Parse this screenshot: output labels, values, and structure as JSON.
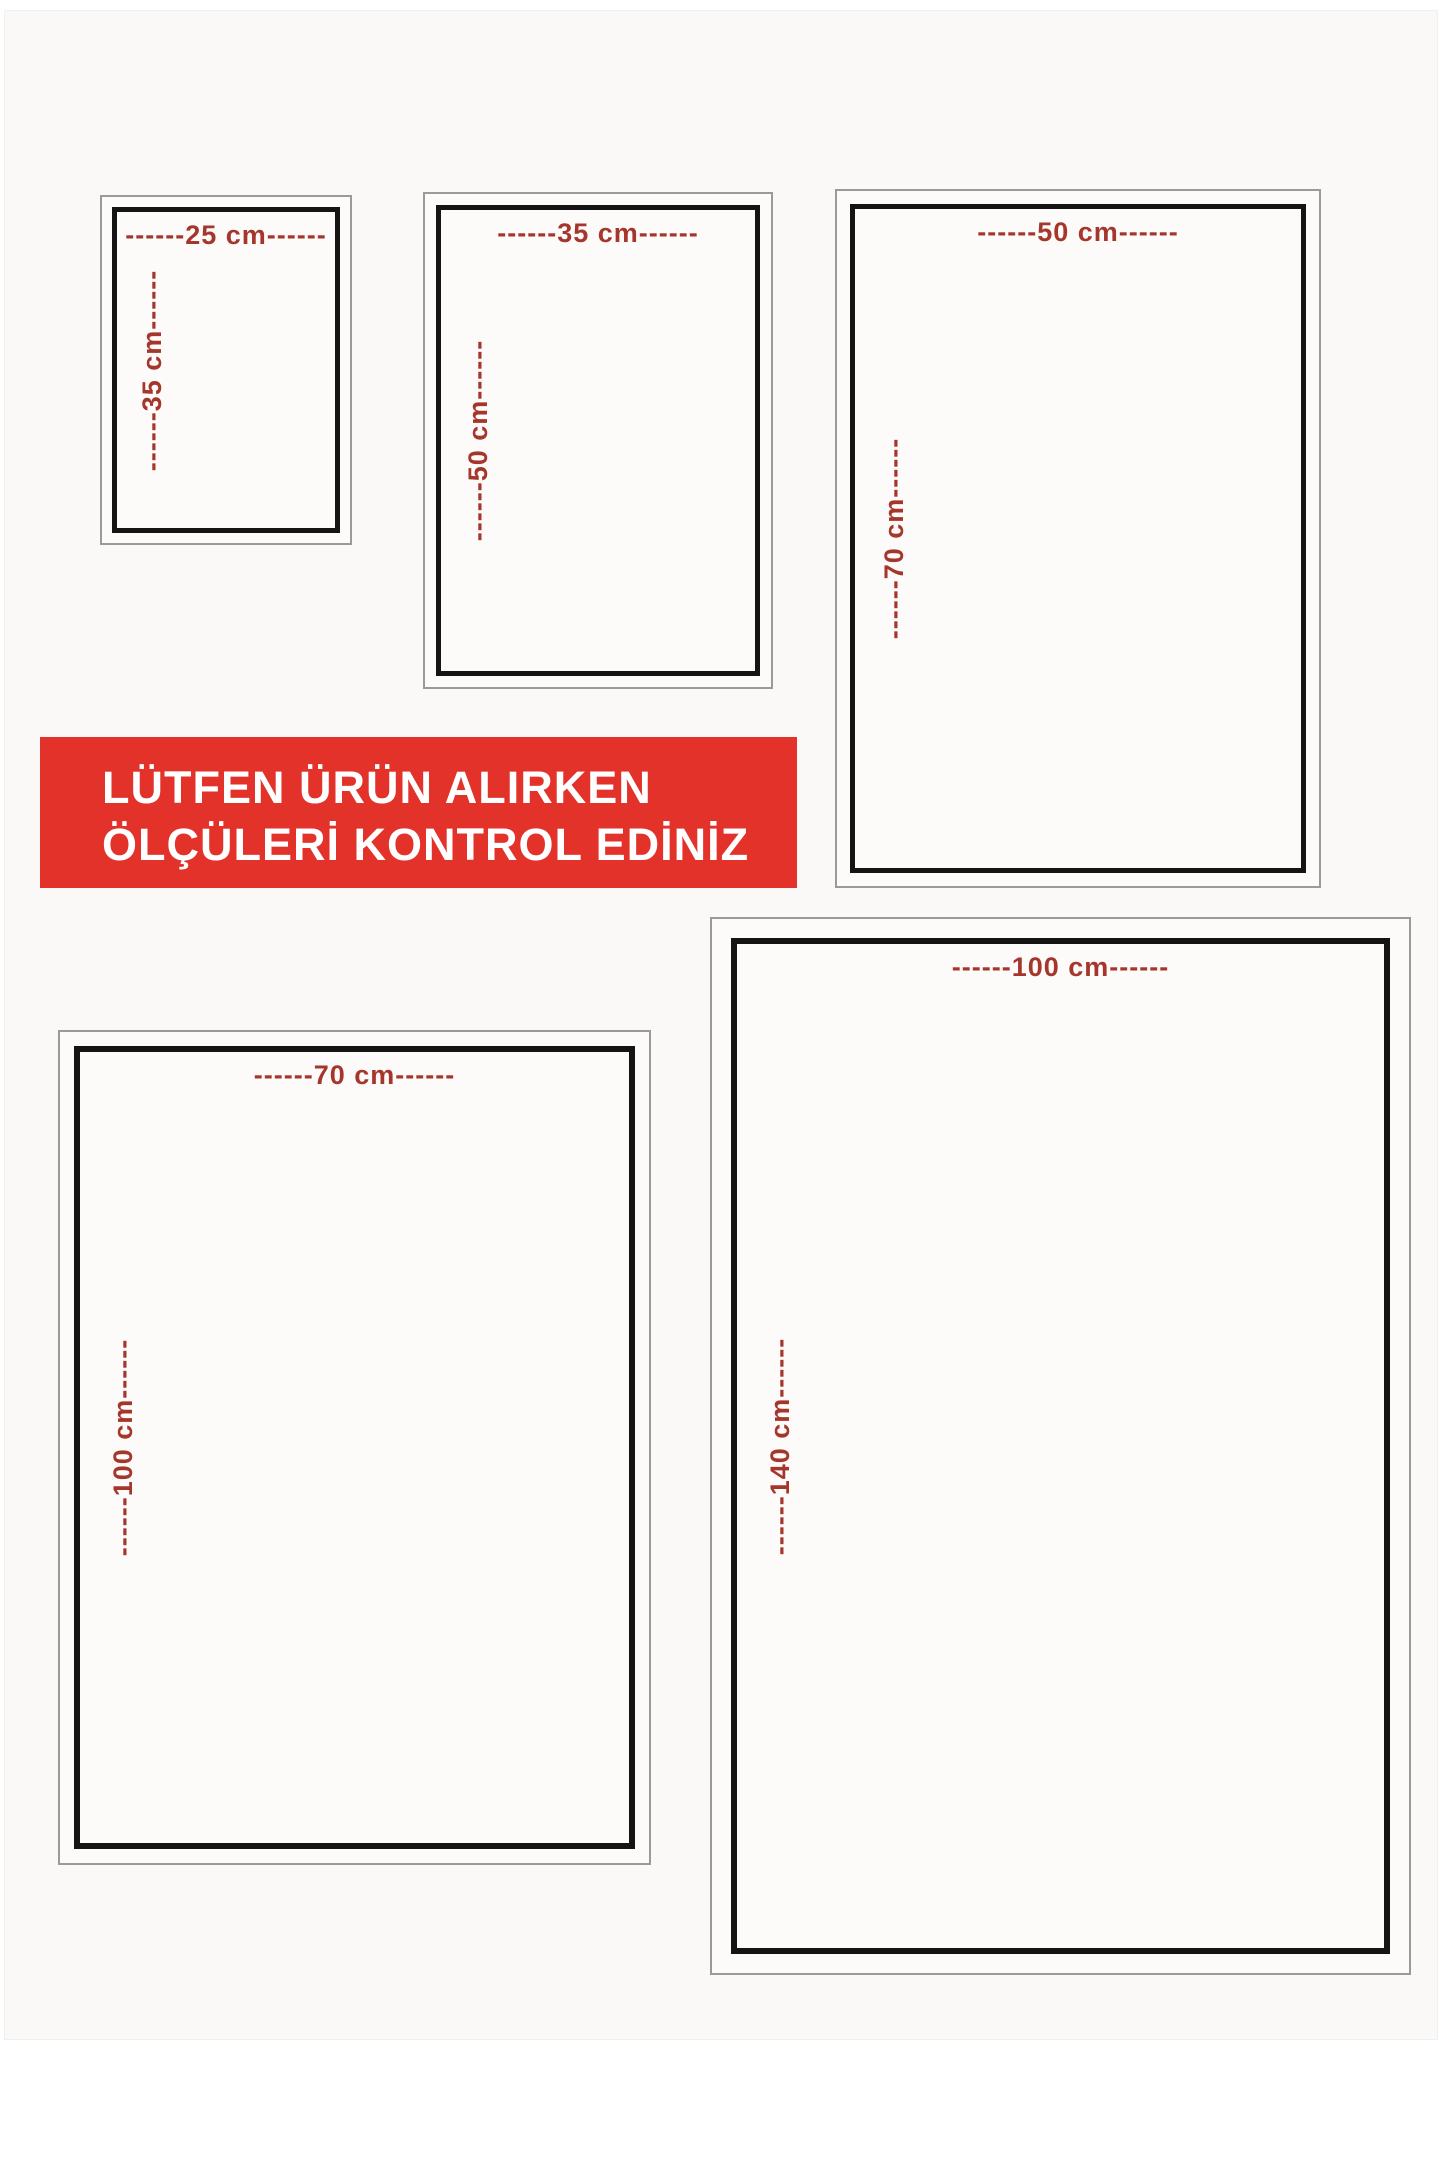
{
  "banner": {
    "line1": "LÜTFEN ÜRÜN ALIRKEN",
    "line2": "ÖLÇÜLERİ KONTROL EDİNİZ",
    "bg_color": "#e23229",
    "text_color": "#ffffff"
  },
  "label_color": "#a5362c",
  "sizes": [
    {
      "name": "25x35",
      "width_cm": 25,
      "height_cm": 35,
      "width_label": "------25 cm------",
      "height_label": "------35 cm------"
    },
    {
      "name": "35x50",
      "width_cm": 35,
      "height_cm": 50,
      "width_label": "------35 cm------",
      "height_label": "------50 cm------"
    },
    {
      "name": "50x70",
      "width_cm": 50,
      "height_cm": 70,
      "width_label": "------50 cm------",
      "height_label": "------70 cm------"
    },
    {
      "name": "70x100",
      "width_cm": 70,
      "height_cm": 100,
      "width_label": "------70 cm------",
      "height_label": "------100 cm------"
    },
    {
      "name": "100x140",
      "width_cm": 100,
      "height_cm": 140,
      "width_label": "------100 cm------",
      "height_label": "------140 cm------"
    }
  ]
}
